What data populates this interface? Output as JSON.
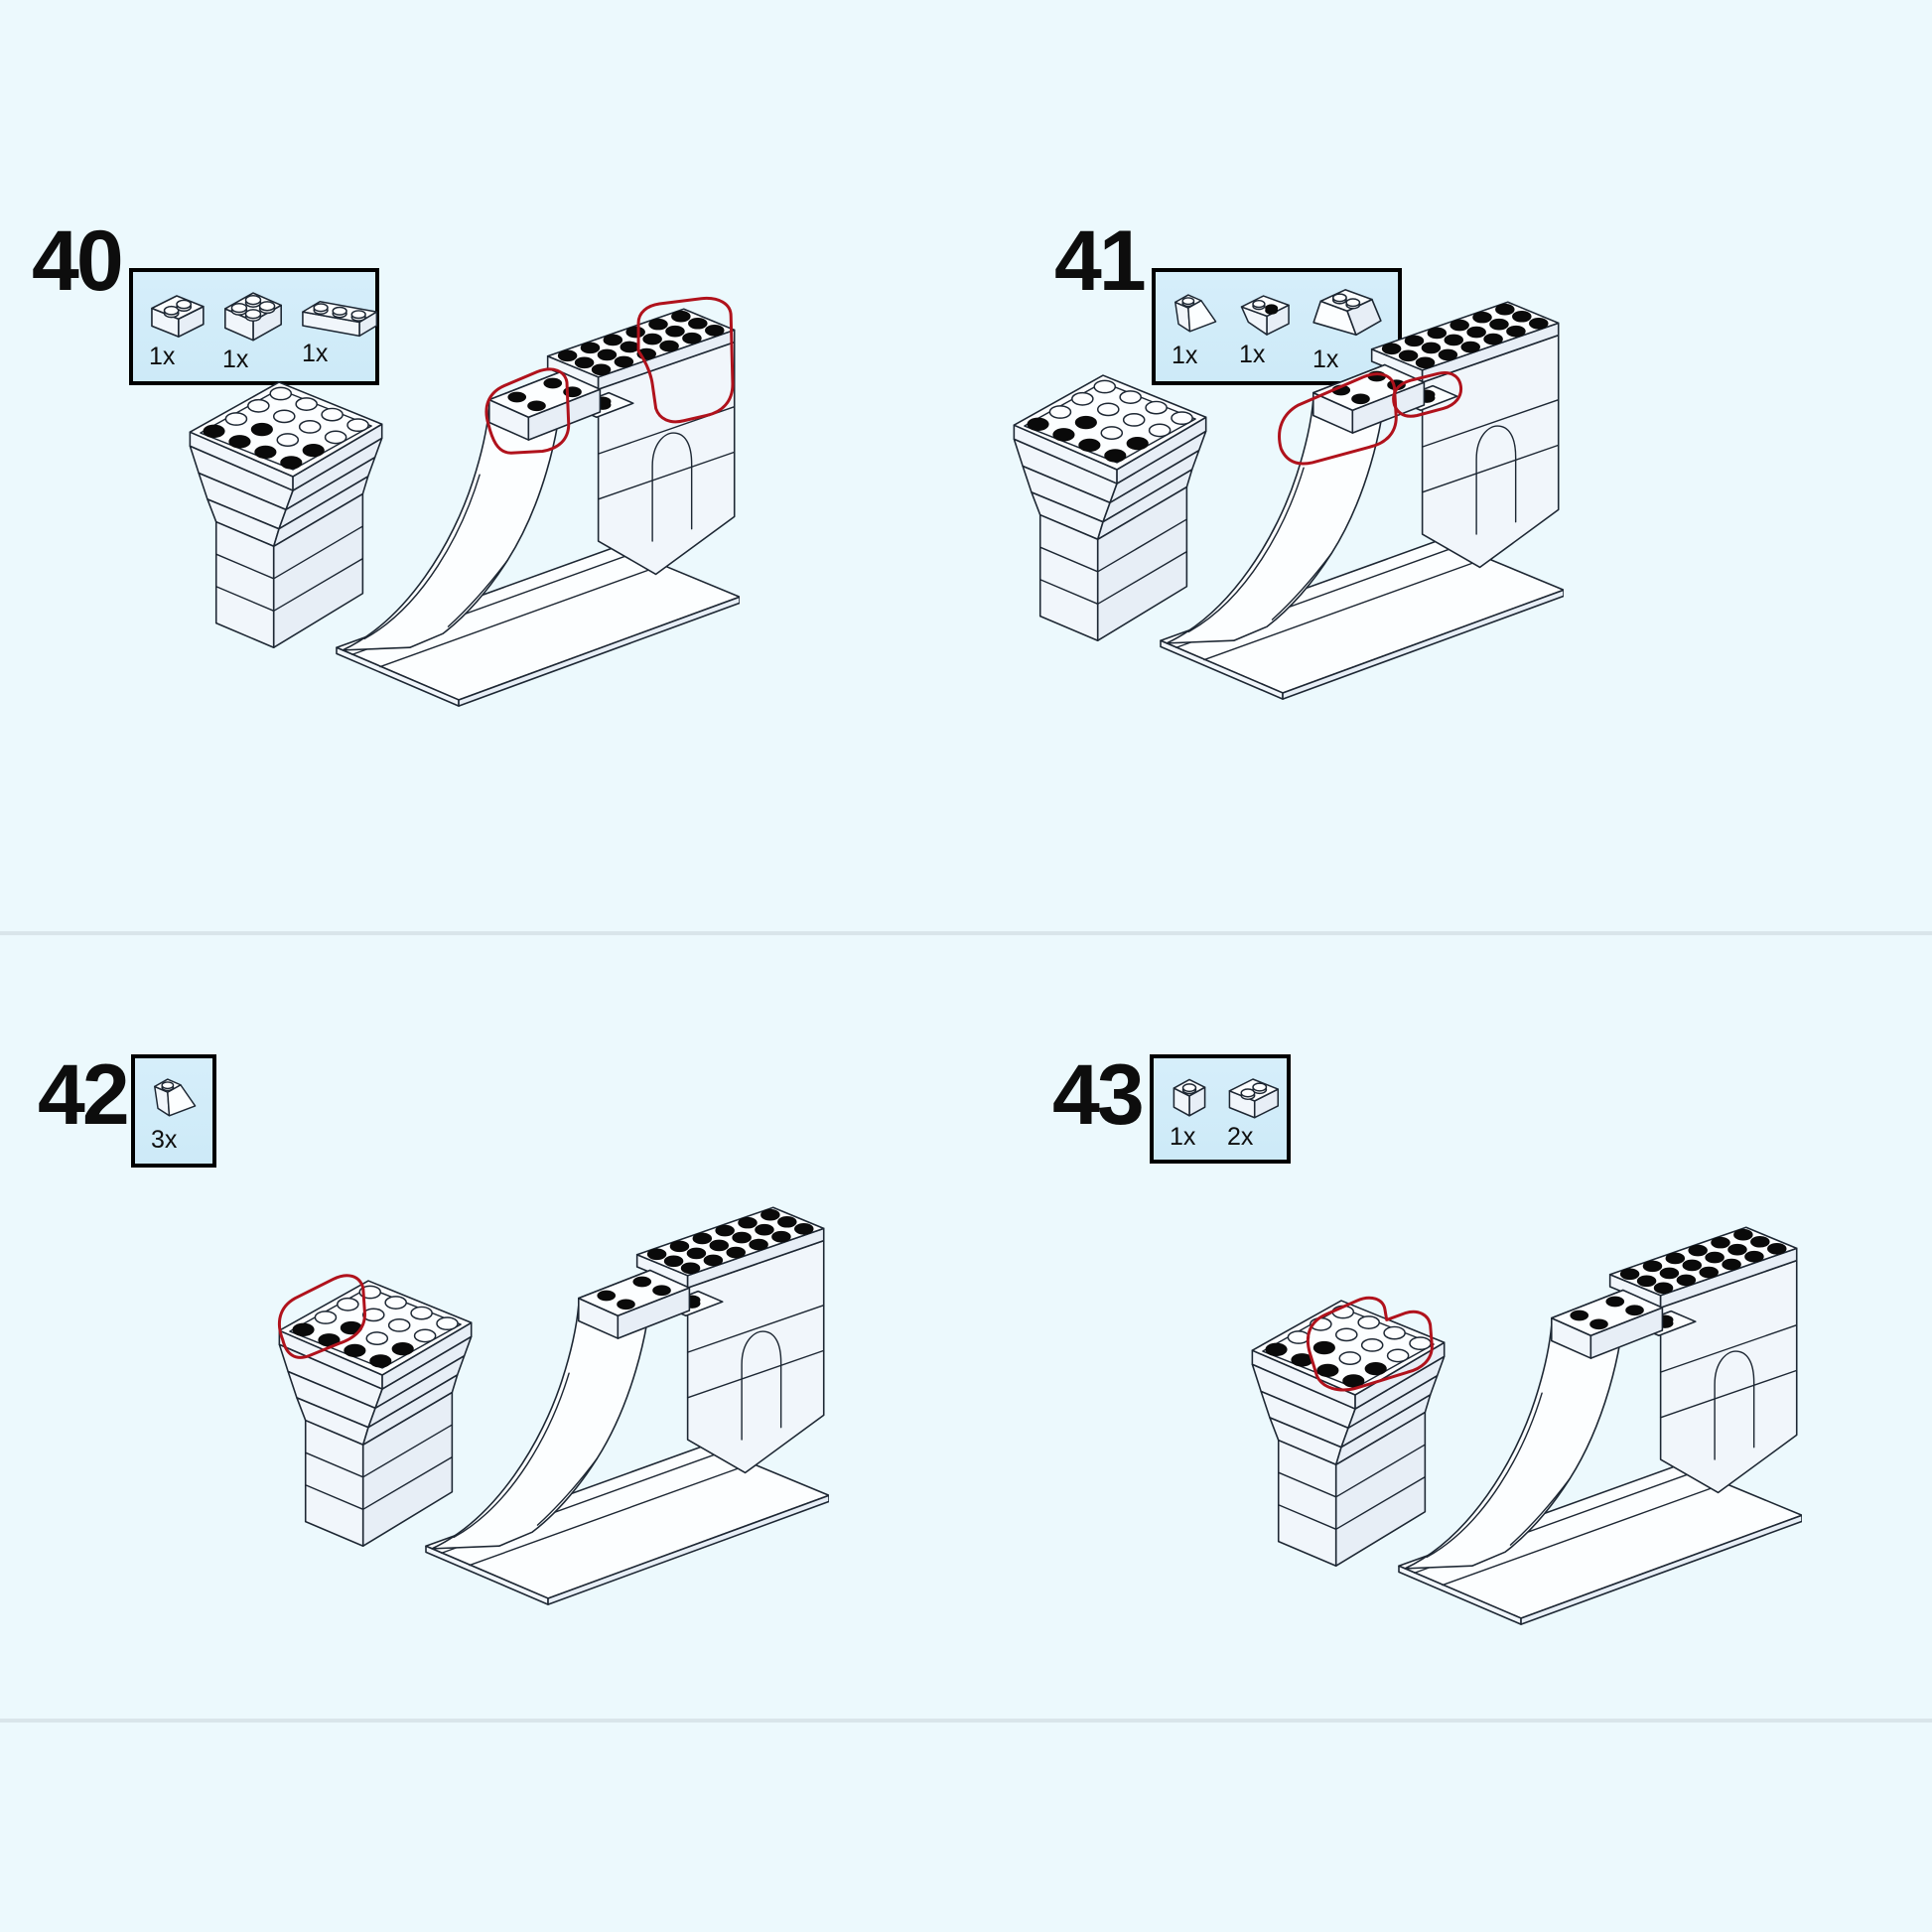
{
  "page": {
    "background_color": "#ecf9fd",
    "divider_color": "#d9e5ea"
  },
  "colors": {
    "highlight_red": "#b0121c",
    "line": "#1d2733",
    "parts_box_fill": "#cdeaf8",
    "parts_box_border": "#000000",
    "stud_black": "#0a0a0a",
    "brick_white": "#fcfeff"
  },
  "steps": [
    {
      "number": "40",
      "parts": [
        {
          "part": "brick-1x2",
          "count": "1x",
          "icon_ref": "#sym-brick-1x2"
        },
        {
          "part": "brick-2x2",
          "count": "1x",
          "icon_ref": "#sym-brick-2x2"
        },
        {
          "part": "brick-1x3",
          "count": "1x",
          "icon_ref": "#sym-brick-1x3"
        }
      ]
    },
    {
      "number": "41",
      "parts": [
        {
          "part": "slope-45-1x2",
          "count": "1x",
          "icon_ref": "#sym-slope-1x2"
        },
        {
          "part": "slope-inverted-1x2-black-stud",
          "count": "1x",
          "icon_ref": "#sym-slope-inv-1x2"
        },
        {
          "part": "slope-45-2x2",
          "count": "1x",
          "icon_ref": "#sym-slope-2x2"
        }
      ]
    },
    {
      "number": "42",
      "parts": [
        {
          "part": "slope-45-1x2",
          "count": "3x",
          "icon_ref": "#sym-slope-1x2"
        }
      ]
    },
    {
      "number": "43",
      "parts": [
        {
          "part": "brick-1x1",
          "count": "1x",
          "icon_ref": "#sym-brick-1x1"
        },
        {
          "part": "brick-1x2",
          "count": "2x",
          "icon_ref": "#sym-brick-1x2"
        }
      ]
    }
  ]
}
